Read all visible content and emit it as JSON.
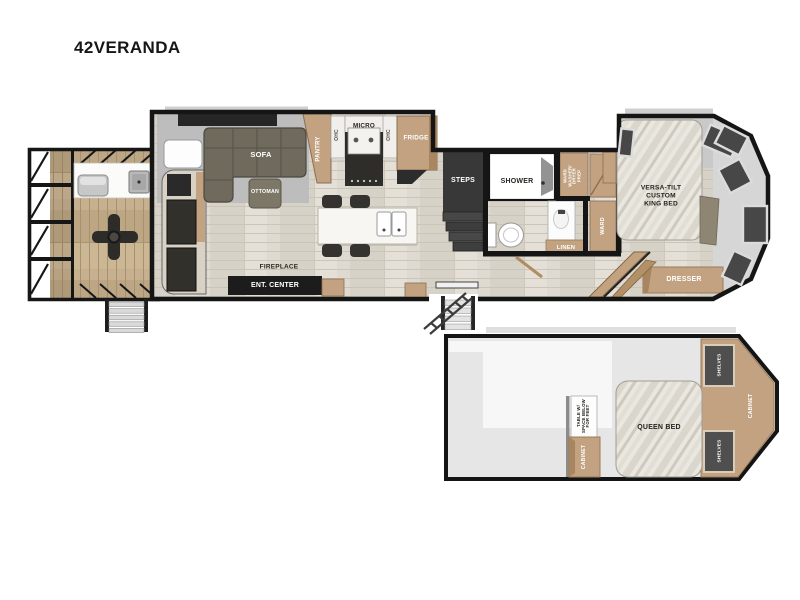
{
  "title": "42VERANDA",
  "colors": {
    "wall": "#151515",
    "cabinet_tan": "#c2a280",
    "dark_furniture": "#34322d",
    "slide_gray": "#bdbdbd",
    "floor_wood": "#dedad1",
    "deck_wood": "#c6b08f",
    "window_glass": "#474747",
    "mattress": "#eae7e0"
  },
  "labels": {
    "sofa": "SOFA",
    "ottoman": "OTTOMAN",
    "pantry": "PANTRY",
    "ohc_left": "OHC",
    "micro": "MICRO",
    "ohc_right": "OHC",
    "fridge": "FRIDGE",
    "fireplace": "FIREPLACE",
    "ent_center": "ENT. CENTER",
    "steps": "STEPS",
    "shower": "SHOWER",
    "ward_washer": "WARD\nWASHER/\nDRYER\nPREP",
    "ward": "WARD",
    "linen": "LINEN",
    "king_bed": "VERSA-TILT\nCUSTOM\nKING BED",
    "dresser": "DRESSER",
    "queen_bed": "QUEEN BED",
    "table_feet": "TABLE W/\nSPACE BELOW\nFOR FEET",
    "cabinet_loft_left": "CABINET",
    "shelves_top": "SHELVES",
    "shelves_bottom": "SHELVES",
    "cabinet_loft_right": "CABINET"
  }
}
